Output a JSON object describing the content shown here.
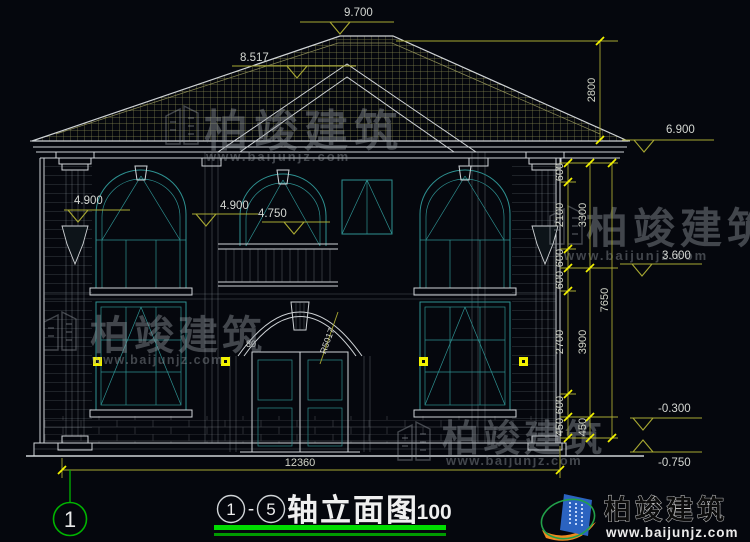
{
  "levels": {
    "ridge": "9.700",
    "roof_break": "8.517",
    "eave": "6.900",
    "window_top_left": "4.900",
    "balcony_a": "4.900",
    "balcony_b": "4.750",
    "story": "3.600",
    "minus_a": "-0.300",
    "minus_b": "-0.750"
  },
  "dims": {
    "total_width": "12360",
    "roof_rise": "2800",
    "chain_inner": [
      "600",
      "2100",
      "600",
      "600",
      "2700",
      "600",
      "450"
    ],
    "chain_mid": [
      "3300",
      "3900",
      "450"
    ],
    "chain_outer": "7650",
    "door_arc_radius": "R5017",
    "door_detail": "80"
  },
  "axis": {
    "bubble_left": "1"
  },
  "title": {
    "axis_from": "1",
    "separator": "-",
    "axis_to": "5",
    "name": "轴立面图",
    "scale": "1:100"
  },
  "watermark": {
    "brand": "柏竣建筑",
    "url": "www.baijunjz.com"
  },
  "logo": {
    "brand": "柏竣建筑",
    "url": "www.baijunjz.com"
  }
}
